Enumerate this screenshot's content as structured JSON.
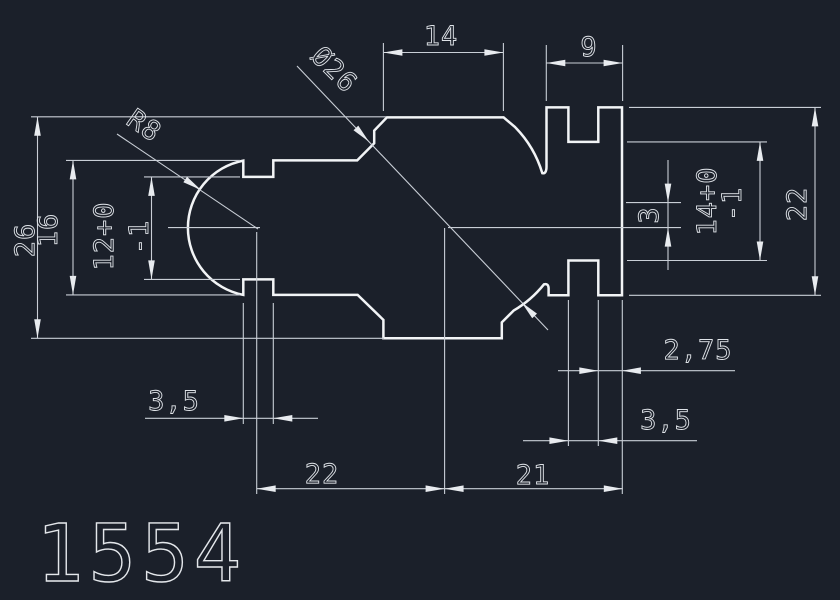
{
  "drawing": {
    "part_number": "1554",
    "colors": {
      "background": "#1b202a",
      "lines": "#e8ebef"
    },
    "dims": {
      "top_width": "14",
      "top_right_tab": "9",
      "diameter": "Ø26",
      "radius": "R8",
      "overall_height": "26",
      "left_shoulder_height": "16",
      "left_opening": "12+0",
      "left_opening_tol": "-1",
      "right_center_offset": "3",
      "right_slot": "14+0",
      "right_slot_tol": "-1",
      "right_height": "22",
      "left_notch_width": "3,5",
      "bottom_left_span": "22",
      "bottom_right_span": "21",
      "right_edge_offset": "2,75",
      "right_notch_width": "3,5"
    }
  }
}
